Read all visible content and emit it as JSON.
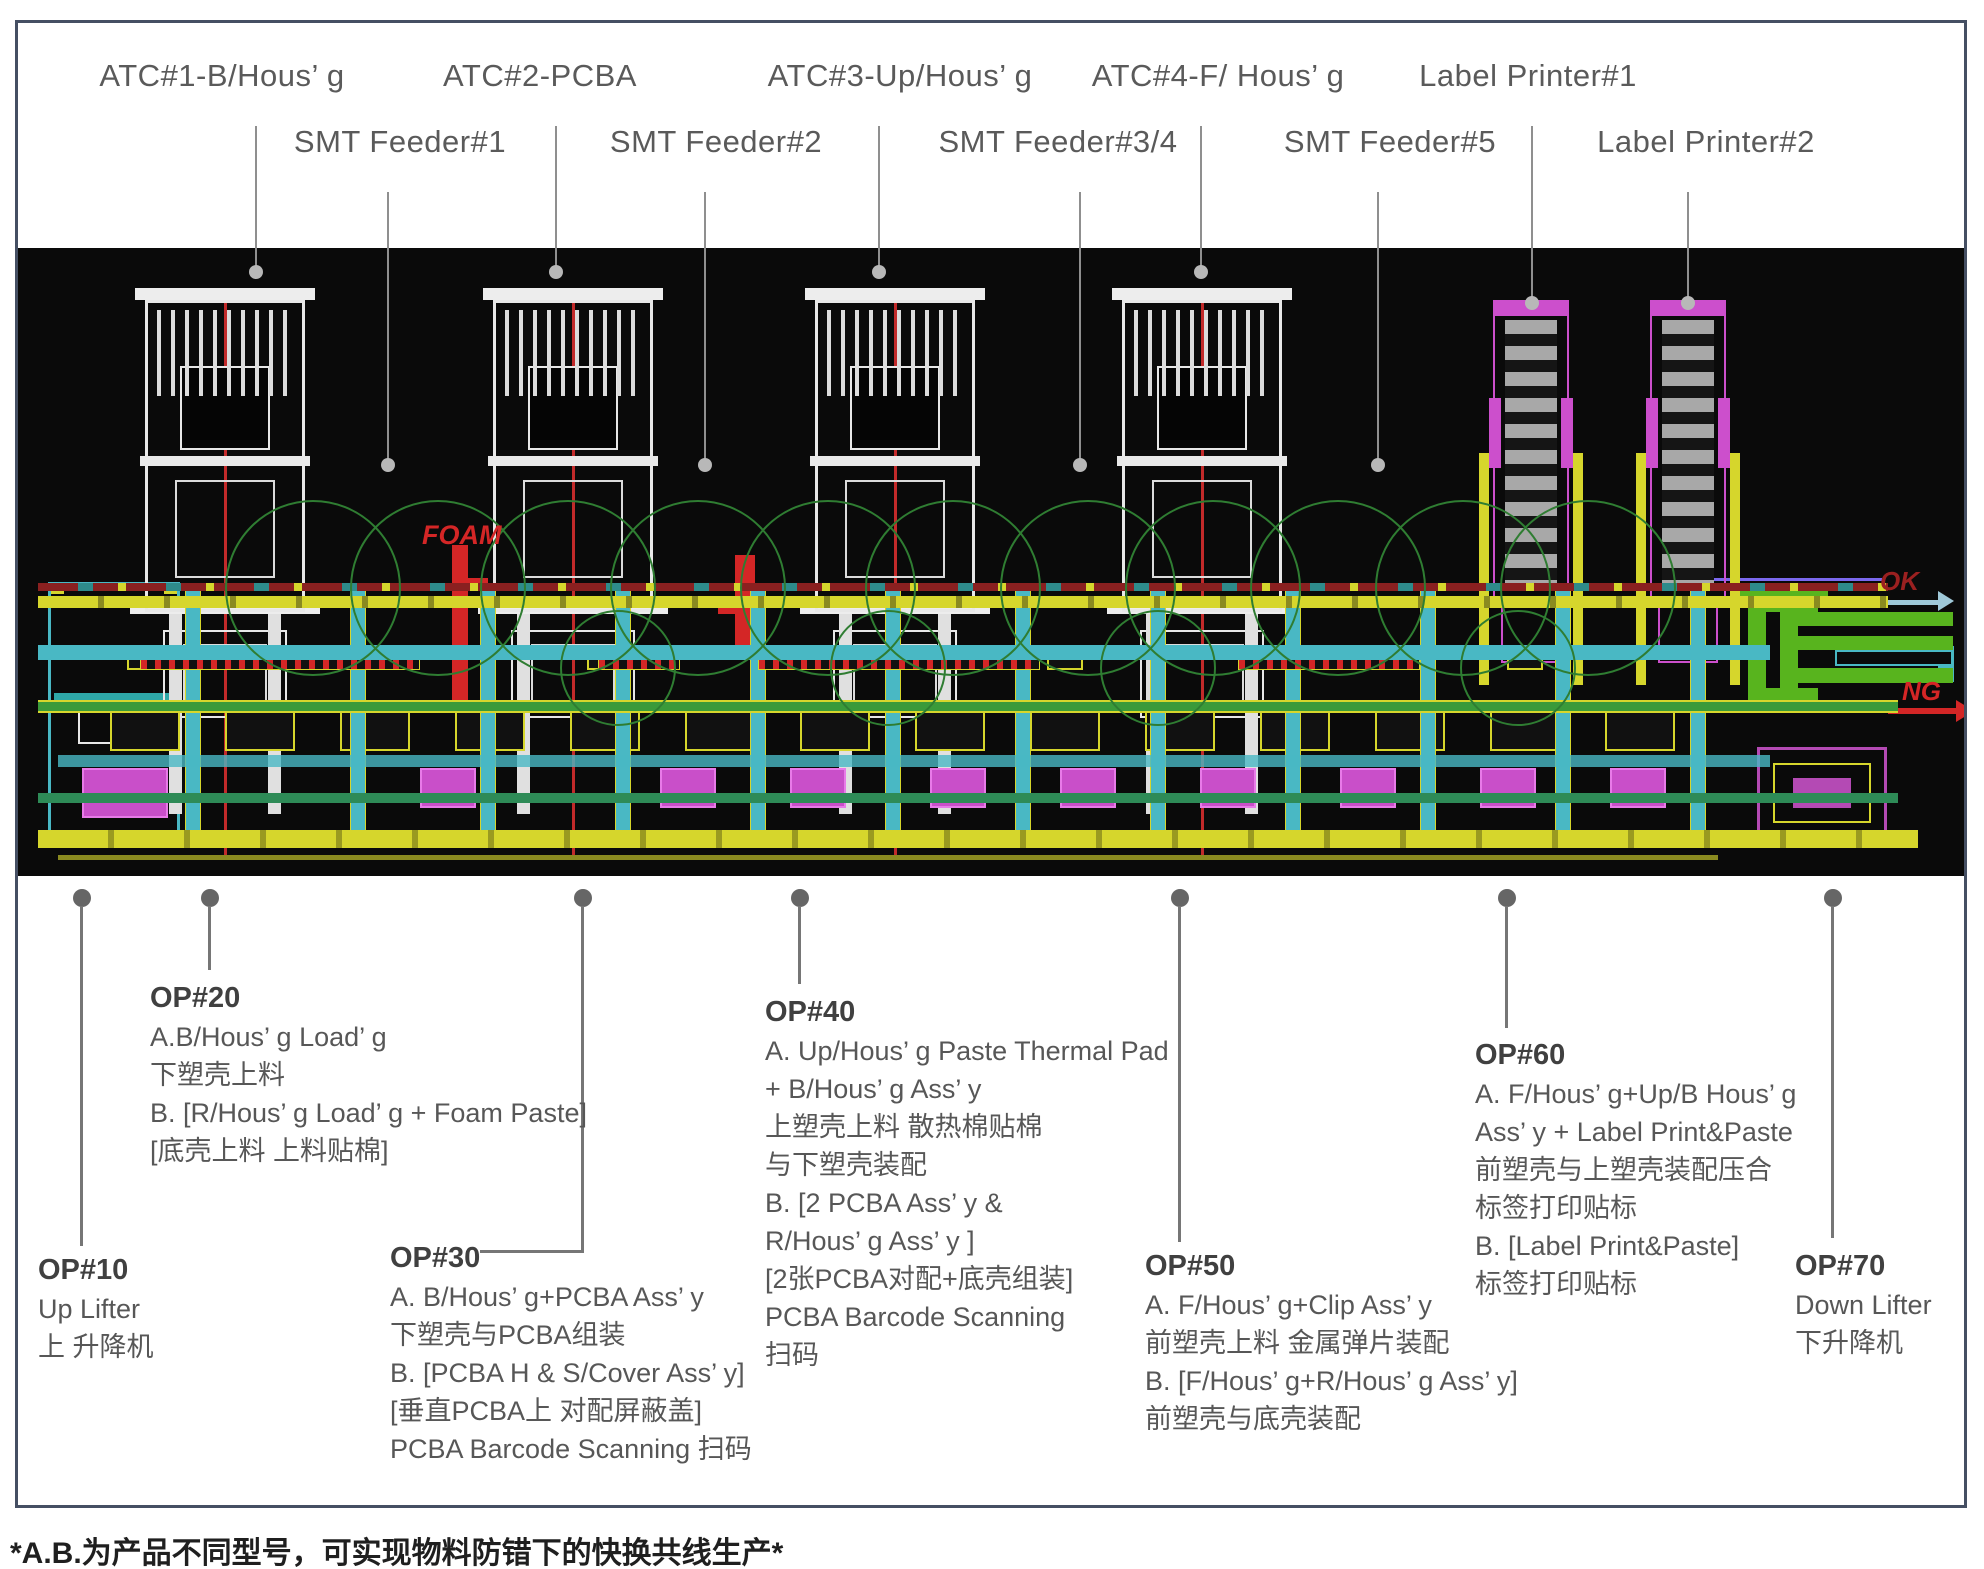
{
  "top_labels": {
    "row1": [
      "ATC#1-B/Hous’ g",
      "ATC#2-PCBA",
      "ATC#3-Up/Hous’ g",
      "ATC#4-F/ Hous’ g",
      "Label Printer#1"
    ],
    "row2": [
      "SMT Feeder#1",
      "SMT Feeder#2",
      "SMT Feeder#3/4",
      "SMT Feeder#5",
      "Label Printer#2"
    ]
  },
  "cad": {
    "foam_label": "FOAM",
    "ok_label": "OK",
    "ng_label": "NG"
  },
  "ops": {
    "op10": {
      "title": "OP#10",
      "lines": [
        "Up Lifter",
        "上 升降机"
      ]
    },
    "op20": {
      "title": "OP#20",
      "lines": [
        "A.B/Hous’ g Load’ g",
        "下塑壳上料",
        "B. [R/Hous’ g Load’ g + Foam Paste]",
        "[底壳上料 上料贴棉]"
      ]
    },
    "op30": {
      "title": "OP#30",
      "lines": [
        "A. B/Hous’ g+PCBA Ass’ y",
        "下塑壳与PCBA组装",
        "B. [PCBA H & S/Cover Ass’ y]",
        "[垂直PCBA上 对配屏蔽盖]",
        "PCBA Barcode Scanning 扫码"
      ]
    },
    "op40": {
      "title": "OP#40",
      "lines": [
        "A. Up/Hous’ g Paste Thermal Pad",
        "+ B/Hous’ g Ass’ y",
        "上塑壳上料 散热棉贴棉",
        "与下塑壳装配",
        "B. [2 PCBA Ass’ y &",
        "R/Hous’ g Ass’ y ]",
        "[2张PCBA对配+底壳组装]",
        "PCBA Barcode Scanning",
        "扫码"
      ]
    },
    "op50": {
      "title": "OP#50",
      "lines": [
        "A. F/Hous’ g+Clip Ass’ y",
        "前塑壳上料 金属弹片装配",
        "B. [F/Hous’ g+R/Hous’ g Ass’ y]",
        "前塑壳与底壳装配"
      ]
    },
    "op60": {
      "title": "OP#60",
      "lines": [
        "A. F/Hous’ g+Up/B Hous’ g",
        "Ass’ y + Label Print&Paste",
        "前塑壳与上塑壳装配压合",
        "标签打印贴标",
        "B. [Label Print&Paste]",
        "标签打印贴标"
      ]
    },
    "op70": {
      "title": "OP#70",
      "lines": [
        "Down Lifter",
        "下升降机"
      ]
    }
  },
  "footnote": "*A.B.为产品不同型号，可实现物料防错下的快换共线生产*",
  "colors": {
    "frame_border": "#454f63",
    "cad_background": "#0a0a0a",
    "cad_yellow": "#d6d62c",
    "cad_cyan": "#49b8c4",
    "cad_green": "#3a9a3a",
    "cad_exit_green": "#58b41e",
    "cad_magenta": "#c94fc9",
    "cad_red": "#d42626",
    "ok_arrow": "#9fc8d8",
    "ng_arrow": "#d42626"
  }
}
